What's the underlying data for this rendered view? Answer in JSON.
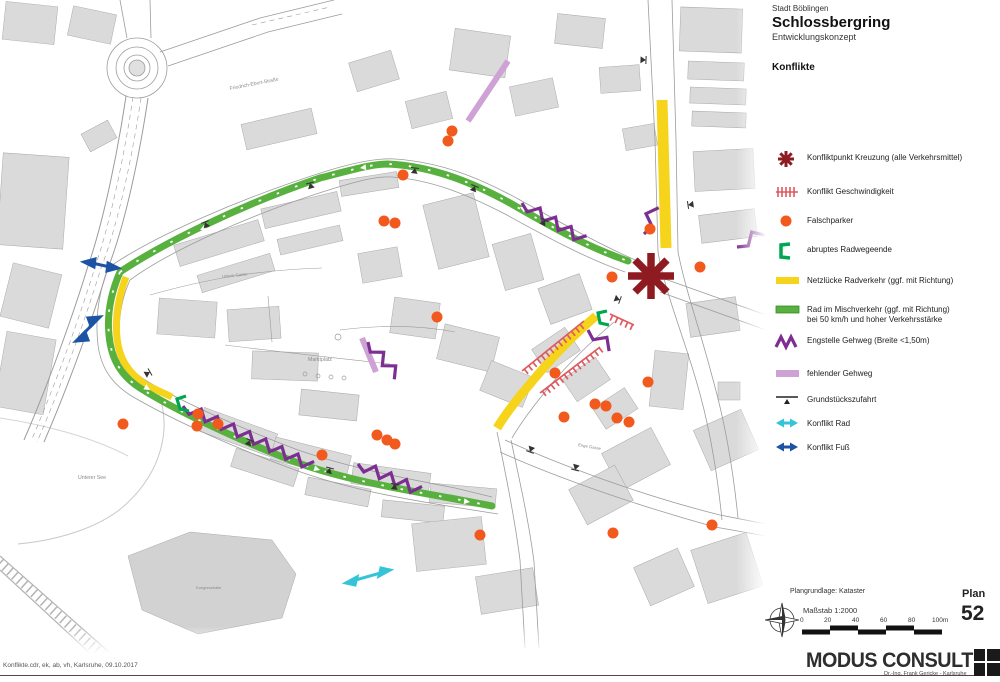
{
  "title_block": {
    "city": "Stadt Böblingen",
    "title": "Schlossbergring",
    "subtitle": "Entwicklungskonzept",
    "section": "Konflikte"
  },
  "legend": {
    "items": [
      {
        "icon": "conflict-star-icon",
        "label": "Konfliktpunkt Kreuzung (alle Verkehrsmittel)"
      },
      {
        "icon": "speed-conflict-icon",
        "label": "Konflikt Geschwindigkeit"
      },
      {
        "icon": "wrong-parking-dot-icon",
        "label": "Falschparker"
      },
      {
        "icon": "bikepath-end-bracket-icon",
        "label": "abruptes Radwegeende"
      },
      {
        "icon": "yellow-gap-bar-icon",
        "label": "Netzlücke Radverkehr (ggf. mit Richtung)"
      },
      {
        "icon": "green-mixed-bar-icon",
        "label": "Rad im Mischverkehr (ggf. mit Richtung)",
        "label2": "bei 50 km/h und hoher Verkehrsstärke"
      },
      {
        "icon": "narrow-sidewalk-zigzag-icon",
        "label": "Engstelle Gehweg (Breite <1,50m)"
      },
      {
        "icon": "missing-sidewalk-bar-icon",
        "label": "fehlender Gehweg"
      },
      {
        "icon": "property-access-icon",
        "label": "Grundstückszufahrt"
      },
      {
        "icon": "bike-conflict-arrow-icon",
        "label": "Konflikt Rad"
      },
      {
        "icon": "foot-conflict-arrow-icon",
        "label": "Konflikt Fuß"
      }
    ]
  },
  "map": {
    "labels": [
      {
        "text": "Friedrich-Ebert-Straße"
      },
      {
        "text": "Untere Gasse"
      },
      {
        "text": "Marktplatz"
      },
      {
        "text": "Unterer See"
      },
      {
        "text": "Enge Gasse"
      },
      {
        "text": "Kongresshalle"
      }
    ]
  },
  "scale_block": {
    "basis": "Plangrundlage: Kataster",
    "scale": "Maßstab 1:2000",
    "ticks": [
      "0",
      "20",
      "40",
      "60",
      "80",
      "100m"
    ],
    "plan_label": "Plan",
    "plan_number": "52"
  },
  "footer": {
    "file_note": "Konflikte.cdr, ek, ab, vh, Karlsruhe, 09.10.2017",
    "company": "MODUS CONSULT",
    "company_sub": "Dr.-Ing. Frank Gericke - Karlsruhe"
  },
  "colors": {
    "conflict_star": "#8e1b21",
    "speed_conflict": "#dd5a5f",
    "wrong_parking": "#f2591d",
    "bikepath_end": "#00a651",
    "network_gap": "#f6d41c",
    "mixed_traffic": "#58b13f",
    "narrow_sidewalk": "#7d2f91",
    "missing_sidewalk": "#cfa2d6",
    "bike_conflict": "#35c4d7",
    "foot_conflict": "#1d53a5"
  }
}
